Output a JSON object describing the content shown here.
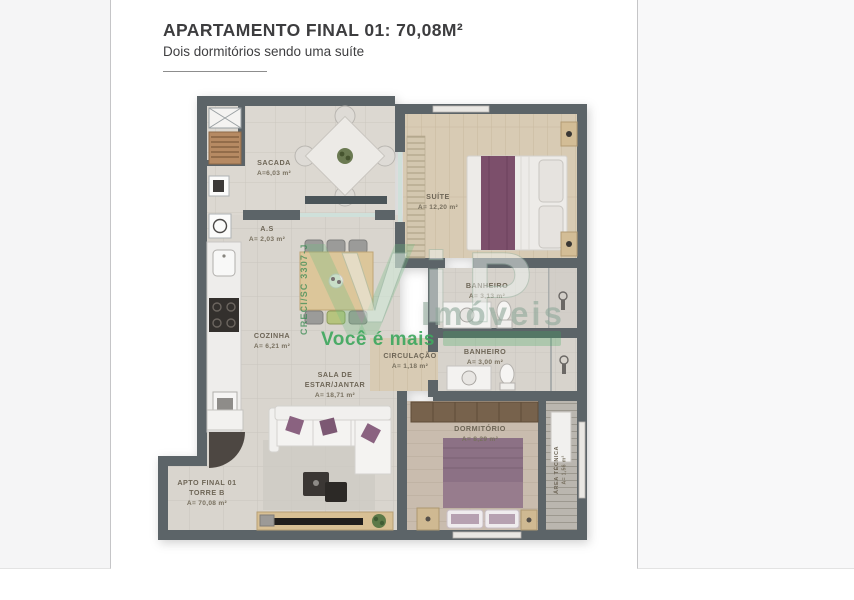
{
  "page": {
    "title": "APARTAMENTO FINAL 01: 70,08M²",
    "subtitle": "Dois dormitórios sendo uma suíte"
  },
  "floorplan": {
    "rooms": {
      "sacada": {
        "name": "SACADA",
        "area": "A=6,03 m²"
      },
      "as": {
        "name": "A.S",
        "area": "A= 2,03 m²"
      },
      "cozinha": {
        "name": "COZINHA",
        "area": "A= 6,21 m²"
      },
      "sala": {
        "name1": "SALA DE",
        "name2": "ESTAR/JANTAR",
        "area": "A= 18,71 m²"
      },
      "suite": {
        "name": "SUÍTE",
        "area": "A= 12,20 m²"
      },
      "banheiro_suite": {
        "name": "BANHEIRO",
        "area": "A= 3,13 m²"
      },
      "banheiro_social": {
        "name": "BANHEIRO",
        "area": "A= 3,00 m²"
      },
      "circulacao": {
        "name": "CIRCULAÇÃO",
        "area": "A= 1,18 m²"
      },
      "dormitorio": {
        "name": "DORMITÓRIO",
        "area": "A= 8,29 m²"
      },
      "area_tecnica": {
        "name": "ÁREA TÉCNICA",
        "area": "A= 1,56 m²"
      },
      "apto": {
        "line1": "APTO FINAL 01",
        "line2": "TORRE B",
        "line3": "A= 70,08 m²"
      }
    },
    "watermark": {
      "brand": "ViP",
      "subbrand": "Imóveis",
      "tagline": "Você é mais",
      "creci": "CRECI/SC 3307-J",
      "green": "#3fa85f"
    },
    "colors": {
      "wall": "#5c6468",
      "accent_purple": "#7c4f6b",
      "watermark_green": "#3fa85f"
    }
  }
}
